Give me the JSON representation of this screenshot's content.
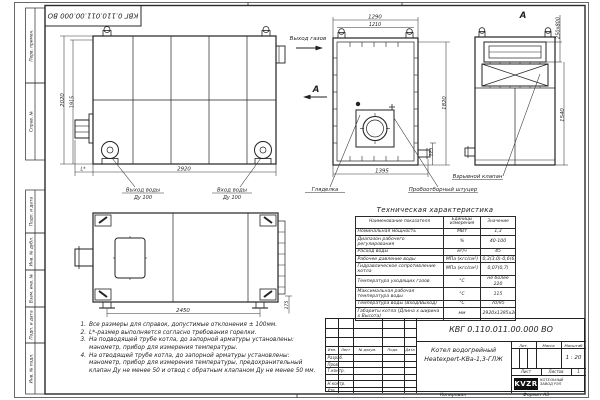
{
  "frame": {
    "stamp_code_top": "КВГ 0.110.011.00.000 ВО",
    "side_labels": [
      "Перв. примен.",
      "Справ. №",
      "Подп. и дата",
      "Инв. № дубл.",
      "Взам. инв. №",
      "Подп. и дата",
      "Инв. № подл."
    ]
  },
  "views": {
    "side": {
      "dim_width": "2920",
      "dim_height_outer": "2020",
      "dim_height_inner": "1915",
      "dim_burner": "L*",
      "label_water_out": "Выход воды",
      "label_water_out_dn": "Ду 100",
      "label_water_in": "Вход воды",
      "label_water_in_dn": "Ду 100"
    },
    "front": {
      "dim_w_outer": "1290",
      "dim_w_inner": "1210",
      "dim_height": "1820",
      "dim_stub": "125",
      "dim_bottom": "1395",
      "label_gas_out": "Выход газов",
      "section_mark": "А",
      "label_peephole": "Гляделка",
      "label_sampling": "Пробоотборный штуцер"
    },
    "section": {
      "title": "А",
      "dim_duct": "250х800",
      "dim_height": "1540",
      "label_valve": "Взрывной клапан"
    },
    "plan": {
      "dim_width": "2450",
      "dim_offset": "175"
    }
  },
  "notes": {
    "items": [
      {
        "num": "1.",
        "text": "Все размеры для справок, допустимые отклонения ± 100мм."
      },
      {
        "num": "2.",
        "text": "L*-размер выполняется согласно требования горелки."
      },
      {
        "num": "3.",
        "text": "На подводящей трубе котла, до запорной арматуры установлены: манометр, прибор для измерения температуры."
      },
      {
        "num": "4.",
        "text": "На отводящей трубе котла, до запорной арматуры установлены: манометр, прибор для измерения температуры, предохранительный клапан Ду не менее 50 и отвод с обратным клапаном Ду не менее 50 мм."
      }
    ]
  },
  "tech_table": {
    "title": "Техническая характеристика",
    "headers": [
      "Наименование показателя",
      "Единицы измерения",
      "Значение"
    ],
    "rows": [
      [
        "Номинальная мощность",
        "МВт",
        "1,3"
      ],
      [
        "Диапазон рабочего регулирования",
        "%",
        "40-100"
      ],
      [
        "Расход воды",
        "м³/ч",
        "45"
      ],
      [
        "Рабочее давление воды",
        "МПа (кгс/см²)",
        "0,3(3,0)-0,6(6,0)"
      ],
      [
        "Гидравлическое сопротивление котла",
        "МПа (кгс/см²)",
        "0,07(0,7)"
      ],
      [
        "Температура уходящих газов",
        "°С",
        "не более 220"
      ],
      [
        "Максимальная рабочая температура воды",
        "°С",
        "115"
      ],
      [
        "Температура воды (Вход/Выход)",
        "°С",
        "70/95"
      ],
      [
        "Габариты котла (Длина х ширина х Высота)",
        "мм",
        "2920х1395х2020"
      ]
    ]
  },
  "title_block": {
    "doc_code": "КВГ 0.110.011.00.000 ВО",
    "product_line1": "Котел водогрейный",
    "product_line2": "Heatexpert-КВа-1,3-ГЛЖ",
    "col_headers": [
      "Изм.",
      "Лист",
      "№ докум.",
      "Подп.",
      "Дата"
    ],
    "row_labels": [
      "Разраб.",
      "Пров.",
      "Т.контр.",
      "",
      "Н.контр.",
      "Утв."
    ],
    "lit_label": "Лит.",
    "mass_label": "Масса",
    "scale_label": "Масштаб",
    "scale_value": "1 : 20",
    "sheet_label": "Лист",
    "sheets_label": "Листов",
    "sheets_value": "1",
    "company_logo": "KVZR",
    "company_name_line1": "КОТЕЛЬНЫЙ",
    "company_name_line2": "ЗАВОД РЭП",
    "footer_copy": "Копировал",
    "footer_format": "Формат А3"
  }
}
